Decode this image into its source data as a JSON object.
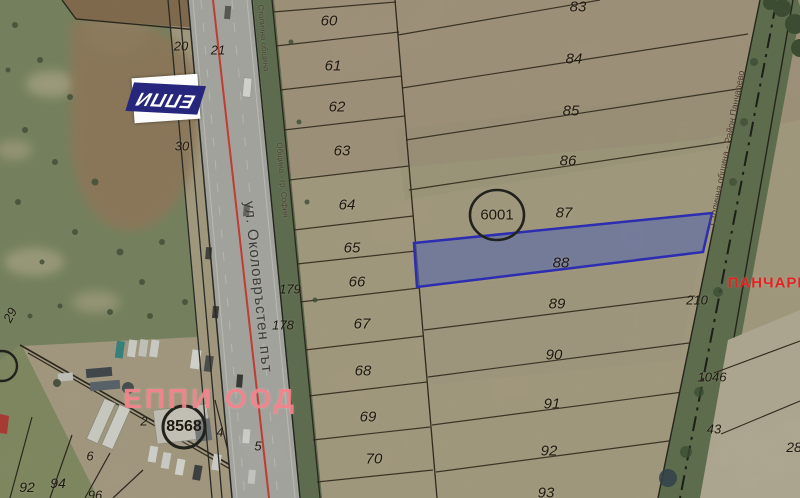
{
  "map": {
    "road_label": "ул. Околовръстен път",
    "watermark": "ЕППИ ООД",
    "logo": "ЕППИ",
    "red_area_label": "ПАНЧАРЕ",
    "selected_parcel": {
      "number": "88",
      "callout": "6001"
    },
    "secondary_callout": "8568",
    "boundary_labels": {
      "left_top": "Столична община",
      "left_mid": "Община - гр. София",
      "right": "Столична община - Район Панчарево"
    },
    "labels": [
      {
        "t": "20",
        "x": 181,
        "y": 46,
        "fs": 13,
        "it": true
      },
      {
        "t": "21",
        "x": 218,
        "y": 50,
        "fs": 13,
        "it": true
      },
      {
        "t": "30",
        "x": 182,
        "y": 146,
        "fs": 13,
        "it": true
      },
      {
        "t": "29",
        "x": 10,
        "y": 315,
        "fs": 13,
        "it": true,
        "r": -62
      },
      {
        "t": "60",
        "x": 329,
        "y": 21,
        "fs": 15,
        "it": true
      },
      {
        "t": "61",
        "x": 333,
        "y": 66,
        "fs": 15,
        "it": true
      },
      {
        "t": "62",
        "x": 337,
        "y": 107,
        "fs": 15,
        "it": true
      },
      {
        "t": "63",
        "x": 342,
        "y": 151,
        "fs": 15,
        "it": true
      },
      {
        "t": "64",
        "x": 347,
        "y": 205,
        "fs": 15,
        "it": true
      },
      {
        "t": "65",
        "x": 352,
        "y": 248,
        "fs": 15,
        "it": true
      },
      {
        "t": "66",
        "x": 357,
        "y": 282,
        "fs": 15,
        "it": true
      },
      {
        "t": "67",
        "x": 362,
        "y": 324,
        "fs": 15,
        "it": true
      },
      {
        "t": "68",
        "x": 363,
        "y": 371,
        "fs": 15,
        "it": true
      },
      {
        "t": "69",
        "x": 368,
        "y": 417,
        "fs": 15,
        "it": true
      },
      {
        "t": "70",
        "x": 374,
        "y": 459,
        "fs": 15,
        "it": true
      },
      {
        "t": "179",
        "x": 290,
        "y": 289,
        "fs": 13,
        "it": true
      },
      {
        "t": "178",
        "x": 283,
        "y": 325,
        "fs": 13,
        "it": true
      },
      {
        "t": "83",
        "x": 578,
        "y": 7,
        "fs": 15,
        "it": true
      },
      {
        "t": "84",
        "x": 574,
        "y": 59,
        "fs": 15,
        "it": true
      },
      {
        "t": "85",
        "x": 571,
        "y": 111,
        "fs": 15,
        "it": true
      },
      {
        "t": "86",
        "x": 568,
        "y": 161,
        "fs": 15,
        "it": true
      },
      {
        "t": "87",
        "x": 564,
        "y": 213,
        "fs": 15,
        "it": true
      },
      {
        "t": "88",
        "x": 561,
        "y": 263,
        "fs": 15,
        "it": true
      },
      {
        "t": "89",
        "x": 557,
        "y": 304,
        "fs": 15,
        "it": true
      },
      {
        "t": "90",
        "x": 554,
        "y": 355,
        "fs": 15,
        "it": true
      },
      {
        "t": "91",
        "x": 552,
        "y": 404,
        "fs": 15,
        "it": true
      },
      {
        "t": "92",
        "x": 549,
        "y": 451,
        "fs": 15,
        "it": true
      },
      {
        "t": "93",
        "x": 546,
        "y": 493,
        "fs": 15,
        "it": true
      },
      {
        "t": "210",
        "x": 697,
        "y": 300,
        "fs": 13,
        "it": true
      },
      {
        "t": "1046",
        "x": 712,
        "y": 377,
        "fs": 13,
        "it": true
      },
      {
        "t": "43",
        "x": 714,
        "y": 429,
        "fs": 13,
        "it": true
      },
      {
        "t": "28",
        "x": 794,
        "y": 447,
        "fs": 14,
        "it": true
      },
      {
        "t": "2",
        "x": 144,
        "y": 421,
        "fs": 13,
        "it": true
      },
      {
        "t": "4",
        "x": 220,
        "y": 432,
        "fs": 13,
        "it": true
      },
      {
        "t": "5",
        "x": 258,
        "y": 446,
        "fs": 13,
        "it": true
      },
      {
        "t": "6",
        "x": 90,
        "y": 456,
        "fs": 13,
        "it": true
      },
      {
        "t": "92",
        "x": 27,
        "y": 487,
        "fs": 14,
        "it": true
      },
      {
        "t": "94",
        "x": 58,
        "y": 483,
        "fs": 14,
        "it": true
      },
      {
        "t": "96",
        "x": 95,
        "y": 495,
        "fs": 13,
        "it": true
      },
      {
        "t": "6001",
        "x": 497,
        "y": 215,
        "fs": 15,
        "n": "callout-6001-label"
      },
      {
        "t": "8568",
        "x": 184,
        "y": 427,
        "fs": 16,
        "b": true,
        "n": "callout-8568-label"
      },
      {
        "t": "ул. Околовръстен път",
        "x": 258,
        "y": 287,
        "fs": 15,
        "r": 84,
        "c": "#3b3b3b",
        "ls": 1,
        "n": "road-name-label"
      },
      {
        "t": "Столична община",
        "x": 263,
        "y": 38,
        "fs": 8,
        "r": 85,
        "c": "#4a4236",
        "n": "boundary-label-left-top"
      },
      {
        "t": "Община - гр. София",
        "x": 282,
        "y": 180,
        "fs": 8,
        "r": 85,
        "c": "#4a4236",
        "n": "boundary-label-left-mid"
      },
      {
        "t": "Столична община - Район Панчарево",
        "x": 727,
        "y": 148,
        "fs": 9,
        "r": -79,
        "c": "#45382a",
        "n": "boundary-label-right"
      },
      {
        "t": "ПАНЧАРЕ",
        "x": 768,
        "y": 283,
        "fs": 15,
        "b": true,
        "c": "#e32222",
        "ls": 1,
        "n": "region-label-panchare"
      },
      {
        "t": "ЕППИ ООД",
        "x": 210,
        "y": 399,
        "fs": 28,
        "b": true,
        "c": "rgba(242,130,139,0.92)",
        "ls": 3,
        "n": "watermark-eppi-ood"
      }
    ]
  },
  "colors": {
    "highlight_fill": "rgba(90,110,200,0.62)",
    "highlight_stroke": "#1f1fd0",
    "watermark_pink": "#f2828b",
    "boundary_red": "#e32222",
    "road_red_line": "#e03030",
    "logo_navy": "#26267c",
    "field_tan": "#b4a88c",
    "scrub_green": "#7c8a64"
  }
}
